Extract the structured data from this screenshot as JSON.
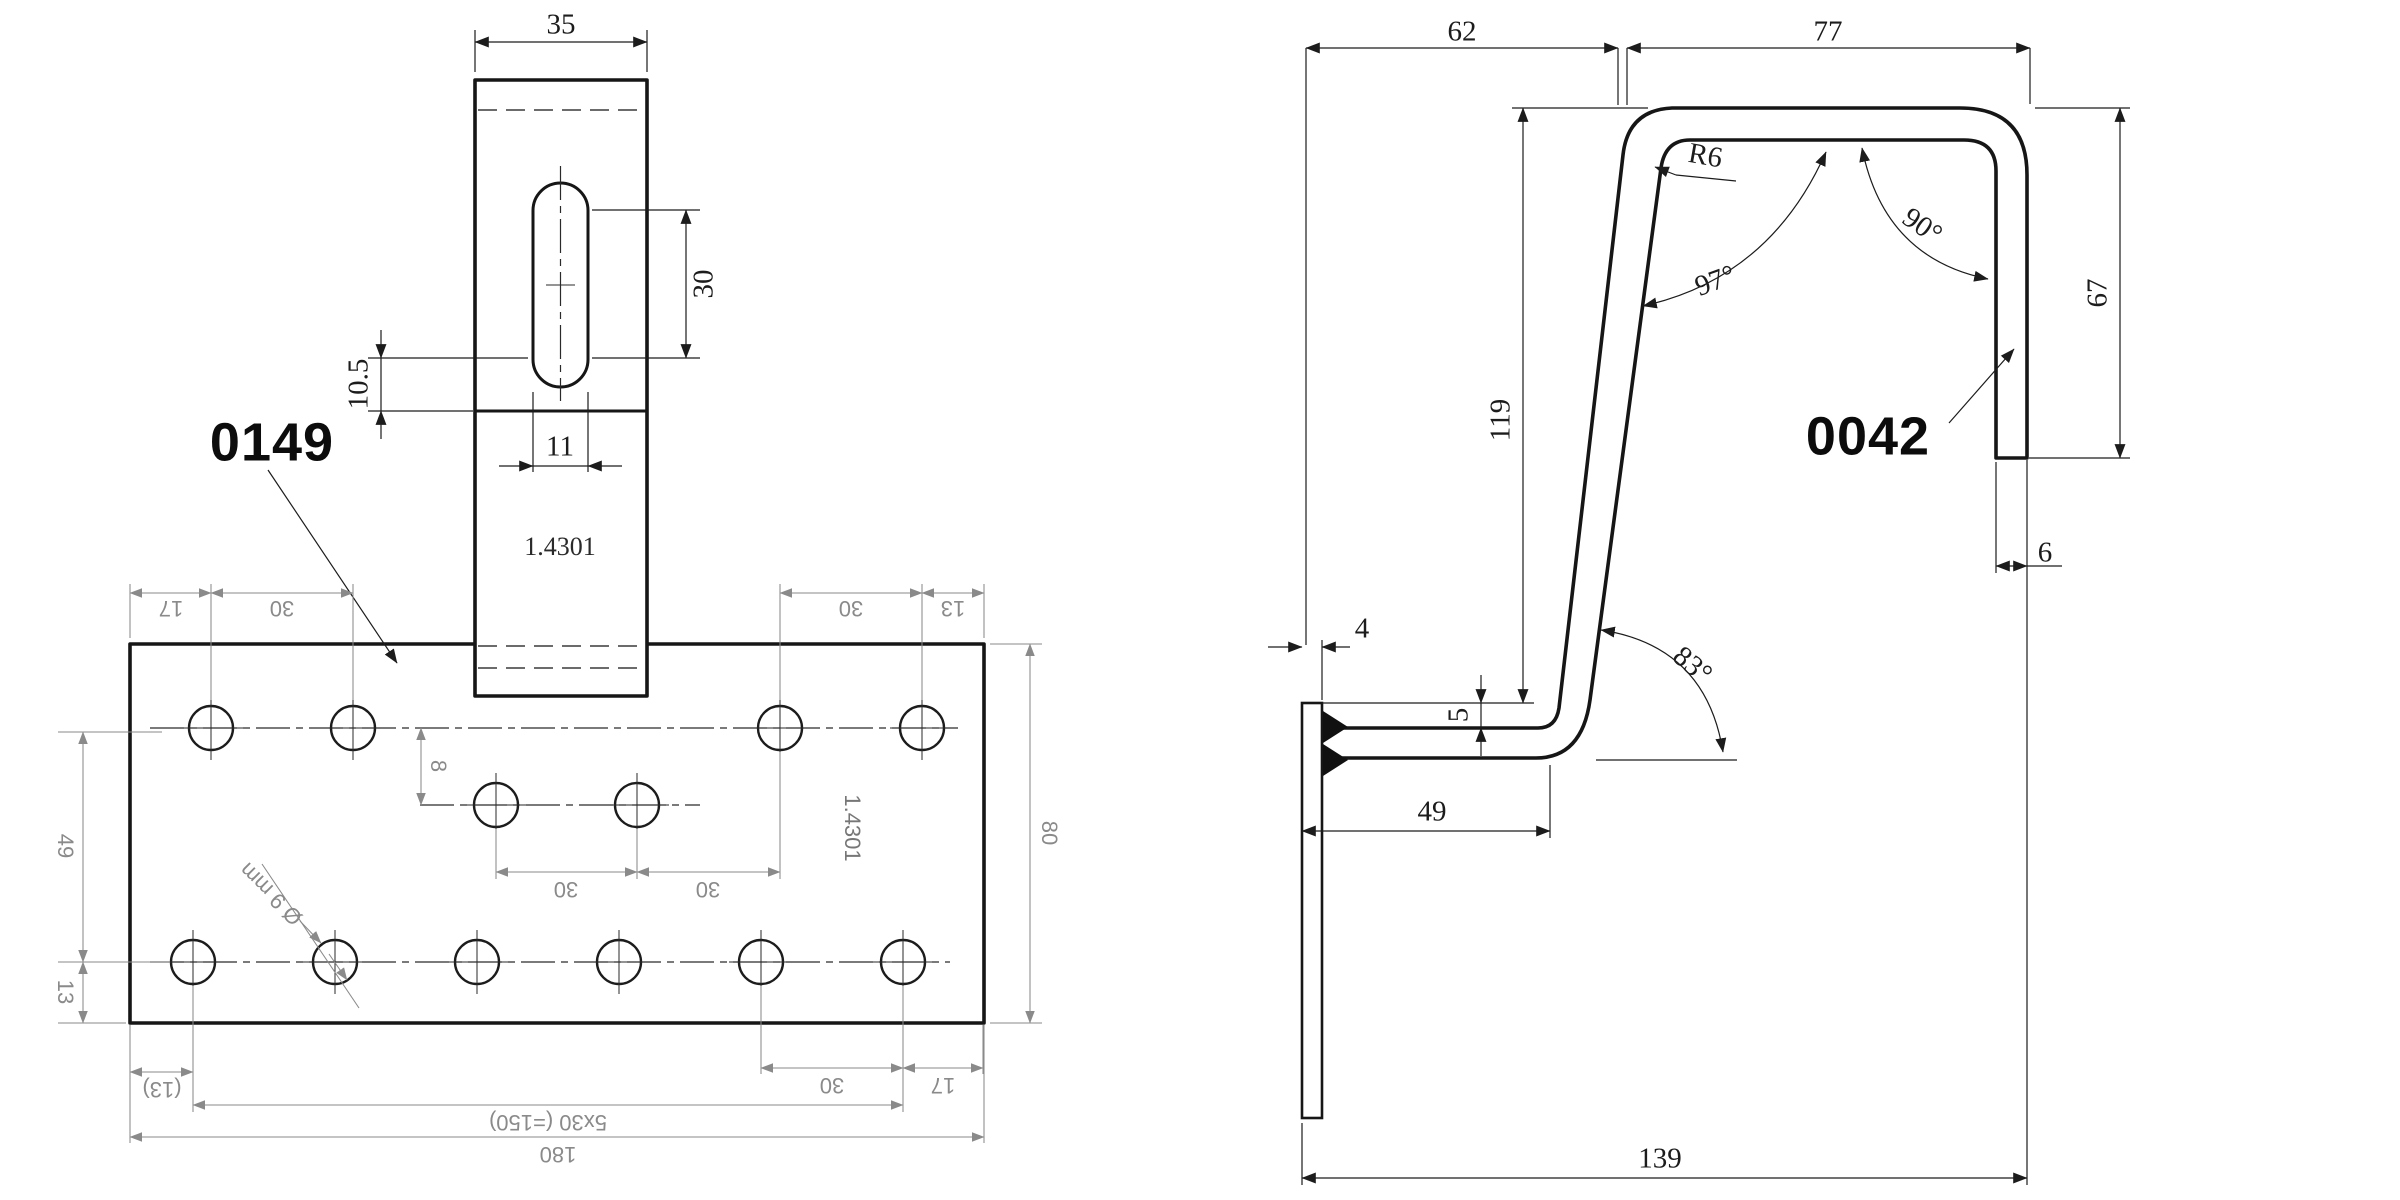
{
  "left": {
    "part_number": "0149",
    "tab_material": "1.4301",
    "plate_material": "1.4301",
    "dim_tab_width": "35",
    "dim_slot_length": "30",
    "dim_slot_offset": "10.5",
    "dim_slot_width": "11",
    "dim_top_margin_left": "17",
    "dim_top_pitch_left": "30",
    "dim_top_pitch_right": "30",
    "dim_top_margin_right": "13",
    "dim_row_offset": "8",
    "dim_mid_pitch_1": "30",
    "dim_mid_pitch_2": "30",
    "dim_row_spacing": "49",
    "dim_bottom_edge": "13",
    "dim_plate_height": "80",
    "hole_callout": "Ø 9 mm",
    "dim_bottom_pitch": "30",
    "dim_bottom_margin_right": "17",
    "dim_bottom_margin_left": "(13)",
    "dim_hole_span": "5x30 (=150)",
    "dim_total_width": "180"
  },
  "right": {
    "part_number": "0042",
    "dim_span_left": "62",
    "dim_span_right": "77",
    "bend_radius": "R6",
    "angle_top_right": "90°",
    "angle_top_left": "97°",
    "dim_leg_height": "67",
    "dim_height": "119",
    "dim_leg_width": "6",
    "dim_strip_width": "4",
    "dim_arm_offset": "5",
    "angle_bottom": "83°",
    "dim_arm_length": "49",
    "dim_total_width": "139"
  }
}
